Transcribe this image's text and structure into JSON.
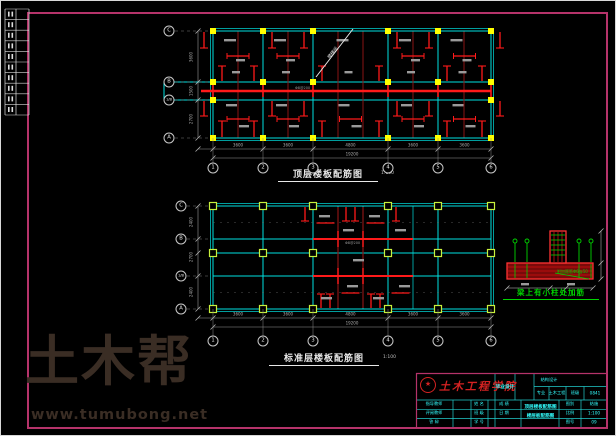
{
  "colors": {
    "frame": "#b5336a",
    "grid": "#00e0e0",
    "rebar": "#ff1a1a",
    "beam_dark": "#8a1515",
    "column_marker": "#ffff00",
    "column_marker_hollow": "#c8f03c",
    "dim": "#9a9a9a",
    "detail_green": "#00d400",
    "watermark": "#3a2d24",
    "titleblock_text": "#33ffff",
    "school_red": "#d42222"
  },
  "watermark": {
    "brand": "土木帮",
    "url": "www.tumubong.net"
  },
  "plans": {
    "top": {
      "title": "顶层楼板配筋图",
      "scale": "1:100",
      "row_axes": [
        "C",
        "B",
        "1/B",
        "A"
      ],
      "col_axes": [
        "1",
        "2",
        "3",
        "4",
        "5",
        "6"
      ],
      "dims": [
        "3600",
        "3600",
        "4800",
        "3600",
        "3600"
      ],
      "dims_total": "19200",
      "dims_left": [
        "3600",
        "1500",
        "2700"
      ],
      "stair_label": "楼梯间",
      "rebar_note": "Φ8@200"
    },
    "bottom": {
      "title": "标准层楼板配筋图",
      "scale": "1:100",
      "row_axes": [
        "C",
        "B",
        "1/B",
        "A"
      ],
      "col_axes": [
        "1",
        "2",
        "3",
        "4",
        "5",
        "6"
      ],
      "dims": [
        "3600",
        "3600",
        "4800",
        "3600",
        "3600"
      ],
      "dims_total": "19200",
      "dims_left": [
        "2400",
        "2700",
        "2400"
      ]
    }
  },
  "detail": {
    "title": "梁上有小柱处加筋",
    "note": "附加箍筋Φ6@50"
  },
  "titleblock": {
    "school": "土木工程学院",
    "doc_type": "毕业设计",
    "project": "结构设计",
    "major_label": "专业",
    "major": "土木工程",
    "class_label": "班级",
    "class_value": "0841",
    "rows": [
      {
        "a": "指导教师",
        "c": "姓 名",
        "d": "成 绩"
      },
      {
        "a": "评阅教师",
        "c": "班 级",
        "d": "日 期"
      },
      {
        "a": "答  辩",
        "c": "学 号",
        "d": ""
      }
    ],
    "drawing_l1": "顶层楼板配筋图",
    "drawing_l2": "楼层板配筋图",
    "right_rows": [
      {
        "label": "图别",
        "value": "结施"
      },
      {
        "label": "比例",
        "value": "1:100"
      },
      {
        "label": "图号",
        "value": "09"
      }
    ]
  }
}
